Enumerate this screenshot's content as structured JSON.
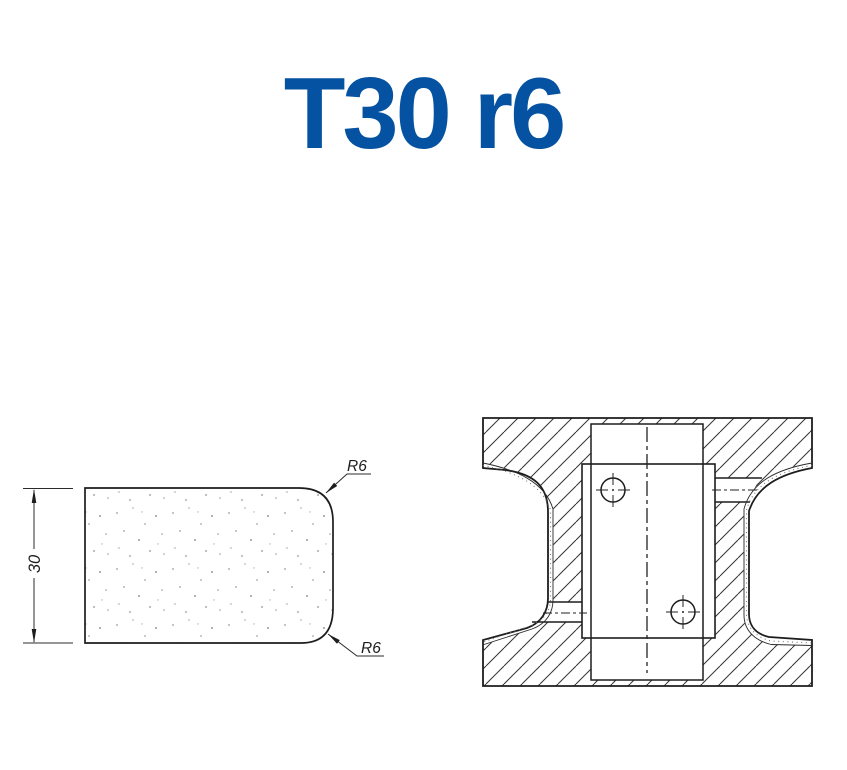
{
  "title": {
    "text": "T30 r6",
    "color": "#0452a1"
  },
  "profile_view": {
    "height_dimension": "30",
    "radius_label_top": "R6",
    "radius_label_bottom": "R6"
  }
}
